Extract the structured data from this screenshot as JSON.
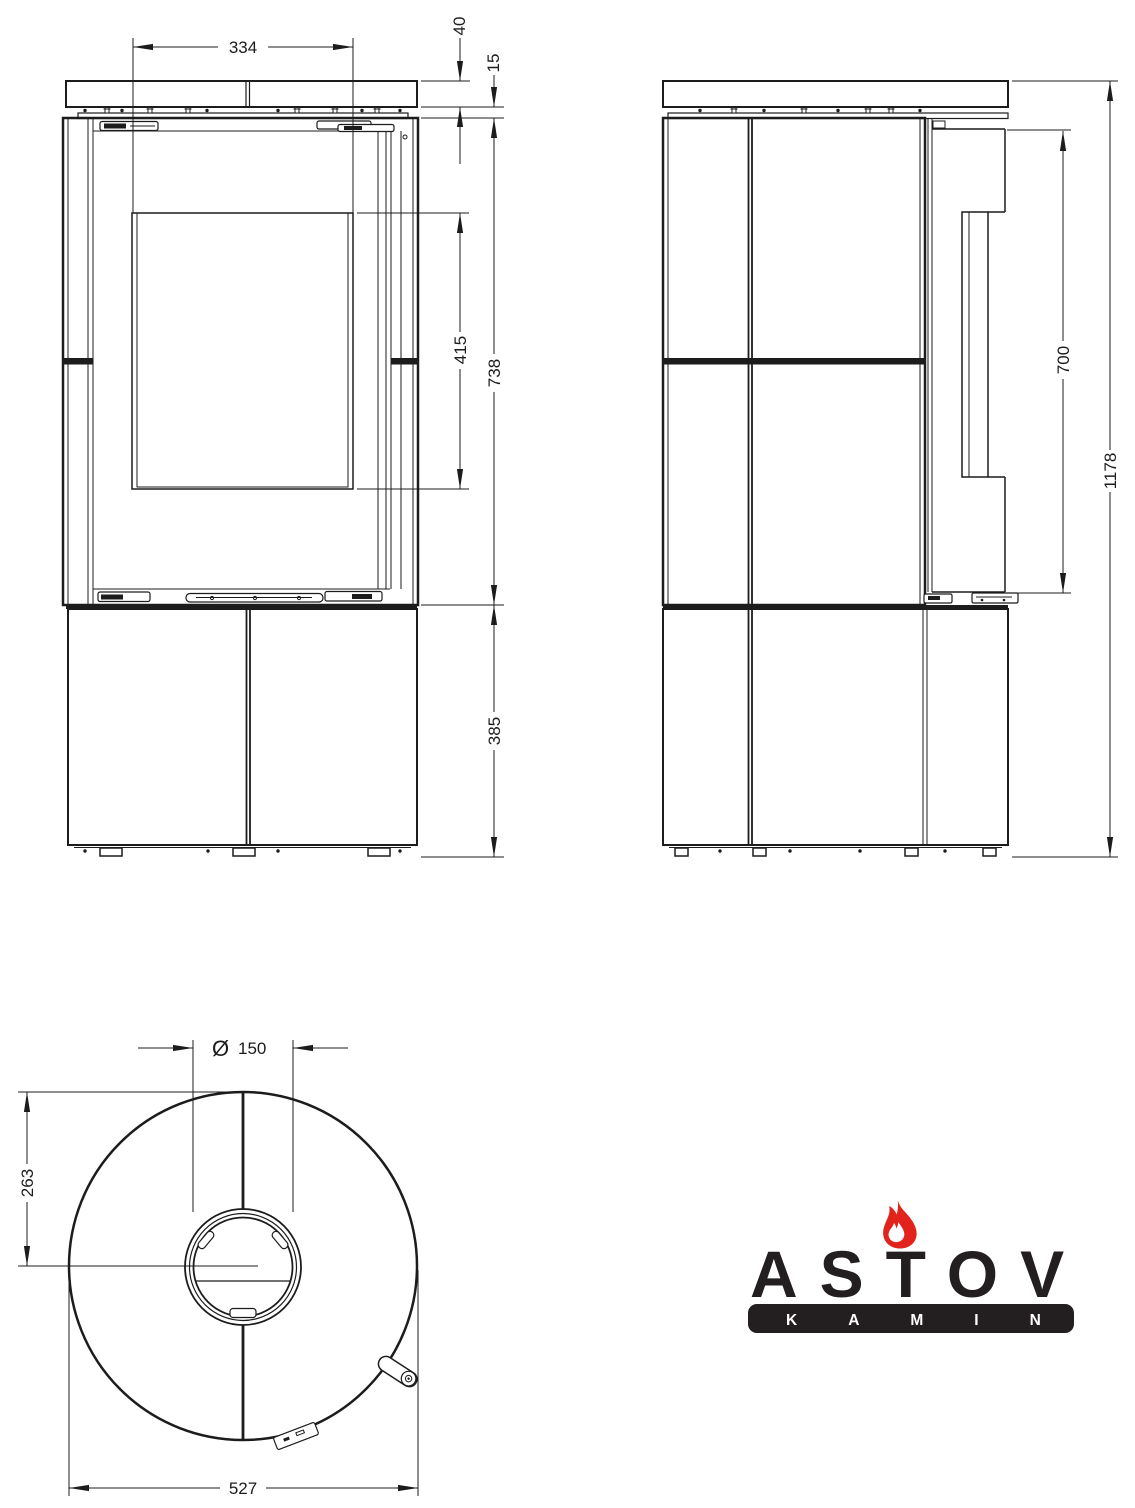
{
  "dimensions": {
    "front_view": {
      "top_plate_width": "334",
      "top_plate_thickness": "40",
      "plate_gap": "15",
      "glass_height": "415",
      "firebox_height": "738",
      "base_height": "385"
    },
    "side_view": {
      "door_height": "700",
      "total_height": "1178"
    },
    "top_view": {
      "flue_diameter_symbol": "Ø",
      "flue_diameter": "150",
      "flue_center_offset": "263",
      "body_diameter": "527"
    }
  },
  "logo": {
    "brand": "ASTOV",
    "subtitle": "KAMIN",
    "flame_color": "#e2231b",
    "text_color": "#231f20"
  },
  "colors": {
    "line": "#1c1c1c",
    "background": "#ffffff"
  }
}
